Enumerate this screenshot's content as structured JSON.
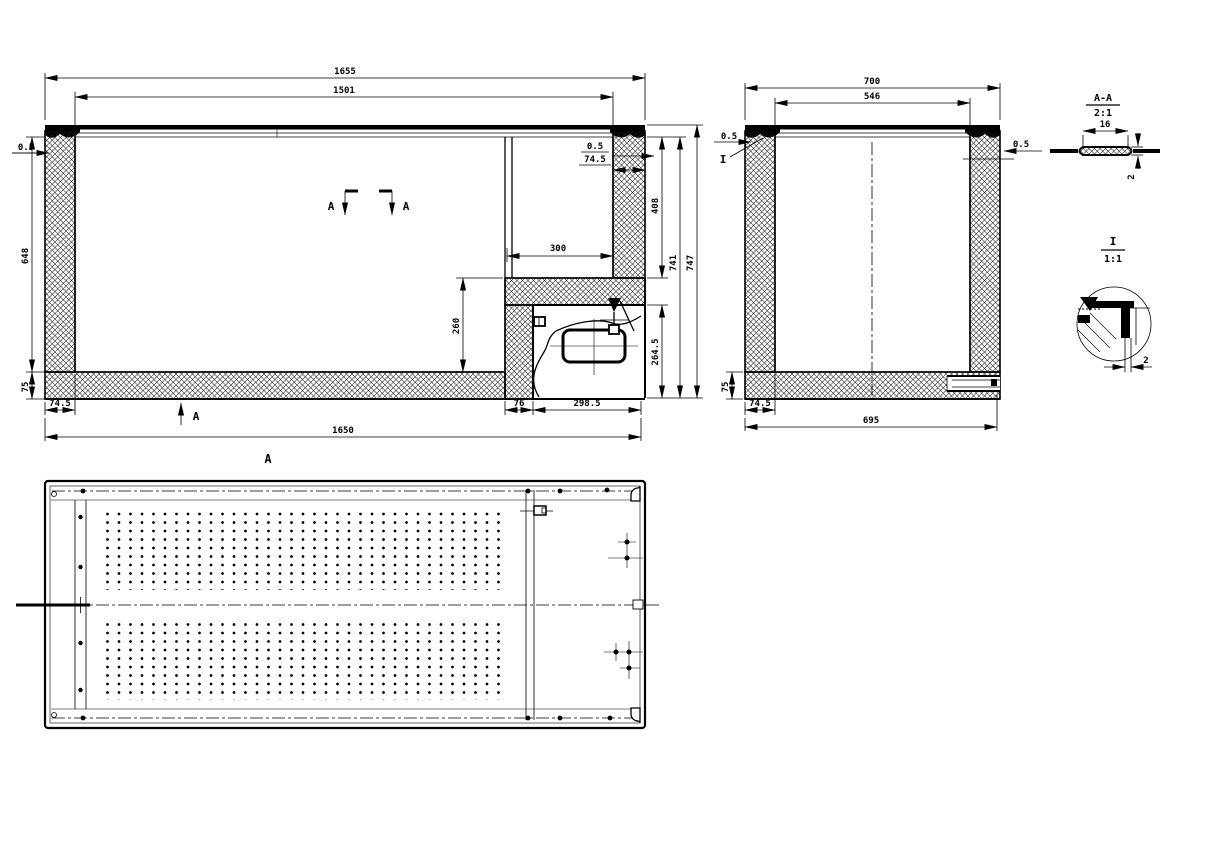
{
  "front_section": {
    "dim_overall_width_top": "1655",
    "dim_inner_width": "1501",
    "dim_lid_gap_left": "0.5",
    "dim_inner_depth": "648",
    "dim_bottom_insulation": "75",
    "dim_left_wall": "74.5",
    "dim_lid_gap_right": "0.5",
    "dim_right_wall": "74.5",
    "dim_recess_width": "300",
    "dim_recess_depth": "408",
    "dim_liner_height": "741",
    "dim_overall_height": "747",
    "dim_step_height": "260",
    "dim_machine_room_height": "264.5",
    "dim_machine_wall": "76",
    "dim_machine_room_width": "298.5",
    "dim_overall_width_bottom": "1650",
    "cut_label_left": "A",
    "cut_label_right": "A",
    "cut_label_bottom": "A",
    "view_label": "A"
  },
  "side_section": {
    "dim_overall_width_top": "700",
    "dim_inner_width": "546",
    "dim_lid_gap_left": "0.5",
    "dim_lid_gap_right": "0.5",
    "detail_marker": "I",
    "dim_bottom_insulation": "75",
    "dim_wall": "74.5",
    "dim_overall_width_bottom": "695"
  },
  "detail_a": {
    "title": "A-A",
    "scale": "2:1",
    "dim_width": "16",
    "dim_thickness": "2"
  },
  "detail_i": {
    "title": "I",
    "scale": "1:1",
    "dim_gap": "2"
  },
  "colors": {
    "line": "#000000",
    "background": "#ffffff"
  }
}
